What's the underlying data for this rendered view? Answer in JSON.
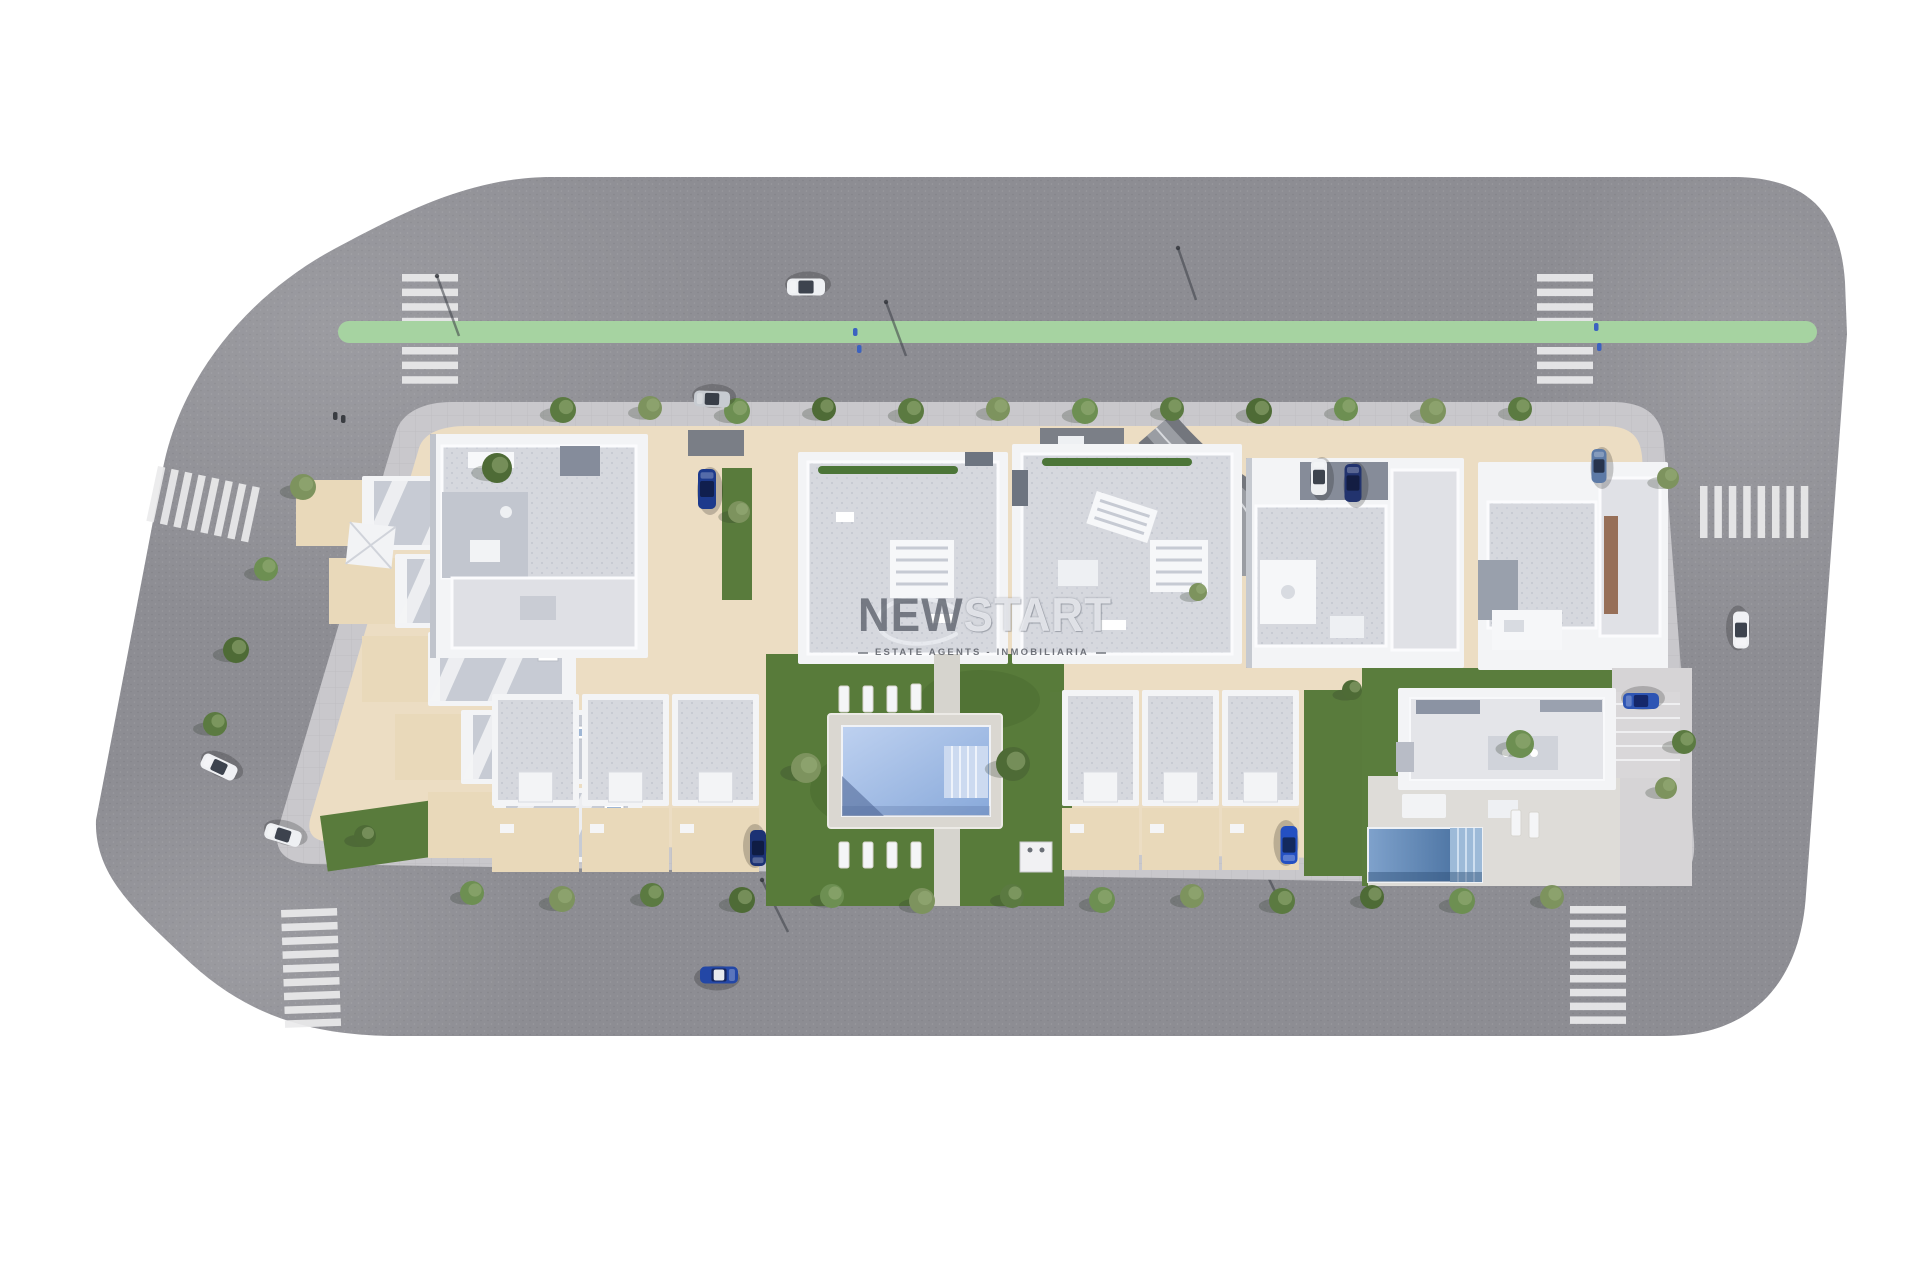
{
  "meta": {
    "kind": "aerial 3D site-plan render of residential development",
    "width": 1920,
    "height": 1280,
    "background": "#ffffff"
  },
  "watermark": {
    "brand_bold": "NEW",
    "brand_light": "START",
    "subtitle": "ESTATE AGENTS - INMOBILIARIA"
  },
  "palette": {
    "asphalt": "#8d8d93",
    "sidewalk": "#c9c8cc",
    "plot_beige": "#ecddc3",
    "yard_beige": "#e9d9ba",
    "grass": "#597b3c",
    "grass_dark": "#42612c",
    "crosswalk": "#eaeaec",
    "bike_lane": "#a6d3a1",
    "roof_light": "#d8dade",
    "roof_speck": "#c6cad3",
    "roof_dark": "#b4b8c3",
    "wall_white": "#f3f4f6",
    "wall_shadow": "#8b92a1",
    "pool_light": "#bed1f0",
    "pool_deep": "#88a9da",
    "pool_steps": "#ccdaf0",
    "villa_pool_light": "#7fa2cc",
    "villa_pool_deep": "#3f6898",
    "deck": "#dad7d1",
    "paving": "#d6d4d6"
  },
  "scene": {
    "bike_lane": {
      "x1": 349,
      "y1": 332,
      "x2": 1806,
      "y2": 332,
      "width": 22
    },
    "crosswalks": [
      {
        "id": "crosswalk-top-left",
        "x": 402,
        "y": 274,
        "rot": 0,
        "orient": "bars-h",
        "count": 8,
        "len": 56,
        "t": 7.5,
        "step": 14.6
      },
      {
        "id": "crosswalk-top-right",
        "x": 1537,
        "y": 274,
        "rot": 0,
        "orient": "bars-h",
        "count": 8,
        "len": 56,
        "t": 7.5,
        "step": 14.6
      },
      {
        "id": "crosswalk-left",
        "x": 158,
        "y": 466,
        "rot": 12,
        "orient": "bars-v",
        "count": 8,
        "len": 56,
        "t": 7.5,
        "step": 13.8
      },
      {
        "id": "crosswalk-bottom-left",
        "x": 281,
        "y": 910,
        "rot": -2,
        "orient": "bars-h",
        "count": 9,
        "len": 56,
        "t": 7.5,
        "step": 13.8
      },
      {
        "id": "crosswalk-bottom-right",
        "x": 1570,
        "y": 906,
        "rot": 0,
        "orient": "bars-h",
        "count": 9,
        "len": 56,
        "t": 7.5,
        "step": 13.8
      },
      {
        "id": "crosswalk-right",
        "x": 1700,
        "y": 486,
        "rot": 0,
        "orient": "bars-v",
        "count": 8,
        "len": 52,
        "t": 7.5,
        "step": 14.4
      }
    ],
    "cars": [
      {
        "id": "car-top-road-white",
        "x": 806,
        "y": 287,
        "rot": 180,
        "len": 38,
        "wid": 17,
        "body": "#eef0f3",
        "glass": "#3d434e"
      },
      {
        "id": "car-top-sidewalk-silver",
        "x": 712,
        "y": 399,
        "rot": 182,
        "len": 36,
        "wid": 16,
        "body": "#c7cbd1",
        "glass": "#383e48"
      },
      {
        "id": "suv-central-driveway-blue",
        "x": 707,
        "y": 489,
        "rot": 270,
        "len": 40,
        "wid": 18,
        "body": "#1d3a8c",
        "glass": "#101f4e"
      },
      {
        "id": "car-right-driveway-white",
        "x": 1319,
        "y": 477,
        "rot": 270,
        "len": 36,
        "wid": 16,
        "body": "#eef0f3",
        "glass": "#3d434e"
      },
      {
        "id": "suv-right-driveway-darkblue",
        "x": 1353,
        "y": 483,
        "rot": 270,
        "len": 38,
        "wid": 17,
        "body": "#22336e",
        "glass": "#131d42"
      },
      {
        "id": "car-topright-block-steelblue",
        "x": 1599,
        "y": 466,
        "rot": 270,
        "len": 34,
        "wid": 15,
        "body": "#5d7aa6",
        "glass": "#27344d"
      },
      {
        "id": "car-left-road-white-1",
        "x": 219,
        "y": 767,
        "rot": 205,
        "len": 37,
        "wid": 16,
        "body": "#f0f1f4",
        "glass": "#3d434e"
      },
      {
        "id": "car-left-road-white-2",
        "x": 283,
        "y": 835,
        "rot": 197,
        "len": 37,
        "wid": 16,
        "body": "#eef0f3",
        "glass": "#3d434e"
      },
      {
        "id": "car-bottom-road-blue-whiteroof",
        "x": 719,
        "y": 975,
        "rot": 0,
        "len": 38,
        "wid": 17,
        "body": "#2347a6",
        "glass": "#16265c",
        "roof": "#e8eaee"
      },
      {
        "id": "car-bottom-inner-darkblue",
        "x": 758,
        "y": 848,
        "rot": 90,
        "len": 36,
        "wid": 16,
        "body": "#1c3274",
        "glass": "#0f1c44"
      },
      {
        "id": "car-bottom-inner-blue",
        "x": 1289,
        "y": 845,
        "rot": 90,
        "len": 38,
        "wid": 17,
        "body": "#2450c2",
        "glass": "#13295e"
      },
      {
        "id": "car-villa-blue",
        "x": 1641,
        "y": 701,
        "rot": 180,
        "len": 36,
        "wid": 16,
        "body": "#2e55b4",
        "glass": "#15276a"
      },
      {
        "id": "car-right-road-white",
        "x": 1741,
        "y": 630,
        "rot": 90,
        "len": 37,
        "wid": 16,
        "body": "#f0f1f4",
        "glass": "#3d434e"
      }
    ],
    "tree_tones": [
      "#6d8f52",
      "#5b7a41",
      "#7d935e",
      "#4e6b36",
      "#87a168"
    ],
    "trees": [
      [
        563,
        410,
        13,
        1
      ],
      [
        650,
        408,
        12,
        2
      ],
      [
        737,
        411,
        13,
        0
      ],
      [
        824,
        409,
        12,
        3
      ],
      [
        911,
        411,
        13,
        1
      ],
      [
        998,
        409,
        12,
        2
      ],
      [
        1085,
        411,
        13,
        0
      ],
      [
        1172,
        409,
        12,
        1
      ],
      [
        1259,
        411,
        13,
        3
      ],
      [
        1346,
        409,
        12,
        0
      ],
      [
        1433,
        411,
        13,
        2
      ],
      [
        1520,
        409,
        12,
        1
      ],
      [
        303,
        487,
        13,
        2
      ],
      [
        266,
        569,
        12,
        0
      ],
      [
        236,
        650,
        13,
        3
      ],
      [
        215,
        724,
        12,
        1
      ],
      [
        472,
        893,
        12,
        0
      ],
      [
        562,
        899,
        13,
        2
      ],
      [
        652,
        895,
        12,
        1
      ],
      [
        742,
        900,
        13,
        3
      ],
      [
        832,
        896,
        12,
        0
      ],
      [
        922,
        901,
        13,
        2
      ],
      [
        1012,
        896,
        12,
        1
      ],
      [
        1102,
        900,
        13,
        0
      ],
      [
        1192,
        896,
        12,
        2
      ],
      [
        1282,
        901,
        13,
        1
      ],
      [
        1372,
        897,
        12,
        3
      ],
      [
        1462,
        901,
        13,
        0
      ],
      [
        1552,
        897,
        12,
        2
      ],
      [
        1668,
        478,
        11,
        2
      ],
      [
        1684,
        742,
        12,
        1
      ],
      [
        497,
        468,
        15,
        3
      ],
      [
        806,
        768,
        15,
        2
      ],
      [
        1013,
        764,
        17,
        3
      ],
      [
        739,
        512,
        11,
        2
      ],
      [
        1198,
        592,
        9,
        2
      ],
      [
        1352,
        690,
        10,
        3
      ],
      [
        1520,
        744,
        14,
        0
      ],
      [
        1666,
        788,
        11,
        2
      ],
      [
        365,
        836,
        11,
        3
      ]
    ],
    "lamps": [
      [
        437,
        276,
        459,
        336
      ],
      [
        886,
        302,
        906,
        356
      ],
      [
        1178,
        248,
        1196,
        300
      ],
      [
        762,
        880,
        788,
        932
      ],
      [
        1258,
        856,
        1283,
        908
      ],
      [
        1663,
        782,
        1671,
        830
      ]
    ],
    "pedestrians": [
      [
        333,
        412,
        "#3a3d42"
      ],
      [
        341,
        415,
        "#3a3d42"
      ],
      [
        853,
        328,
        "#3b62c0"
      ],
      [
        857,
        345,
        "#3b62c0"
      ],
      [
        1594,
        323,
        "#3b62c0"
      ],
      [
        1597,
        343,
        "#3b62c0"
      ],
      [
        947,
        702,
        "#474c54"
      ],
      [
        463,
        706,
        "#474c54"
      ]
    ],
    "townhouse_rows": {
      "count": 5,
      "x0": 296,
      "y0": 476,
      "dx": 33,
      "dy": 78,
      "w": 214,
      "h": 74,
      "yard_w": 66
    },
    "bottom_rows": [
      {
        "x": 492,
        "y": 694,
        "units": 3,
        "uw": 90,
        "roof_h": 112,
        "yard_h": 64
      },
      {
        "x": 1062,
        "y": 690,
        "units": 3,
        "uw": 80,
        "roof_h": 116,
        "yard_h": 62
      }
    ],
    "loungers": [
      [
        844,
        686
      ],
      [
        868,
        686
      ],
      [
        892,
        686
      ],
      [
        916,
        684
      ],
      [
        844,
        842
      ],
      [
        868,
        842
      ],
      [
        892,
        842
      ],
      [
        916,
        842
      ],
      [
        1516,
        810
      ],
      [
        1534,
        812
      ]
    ]
  }
}
